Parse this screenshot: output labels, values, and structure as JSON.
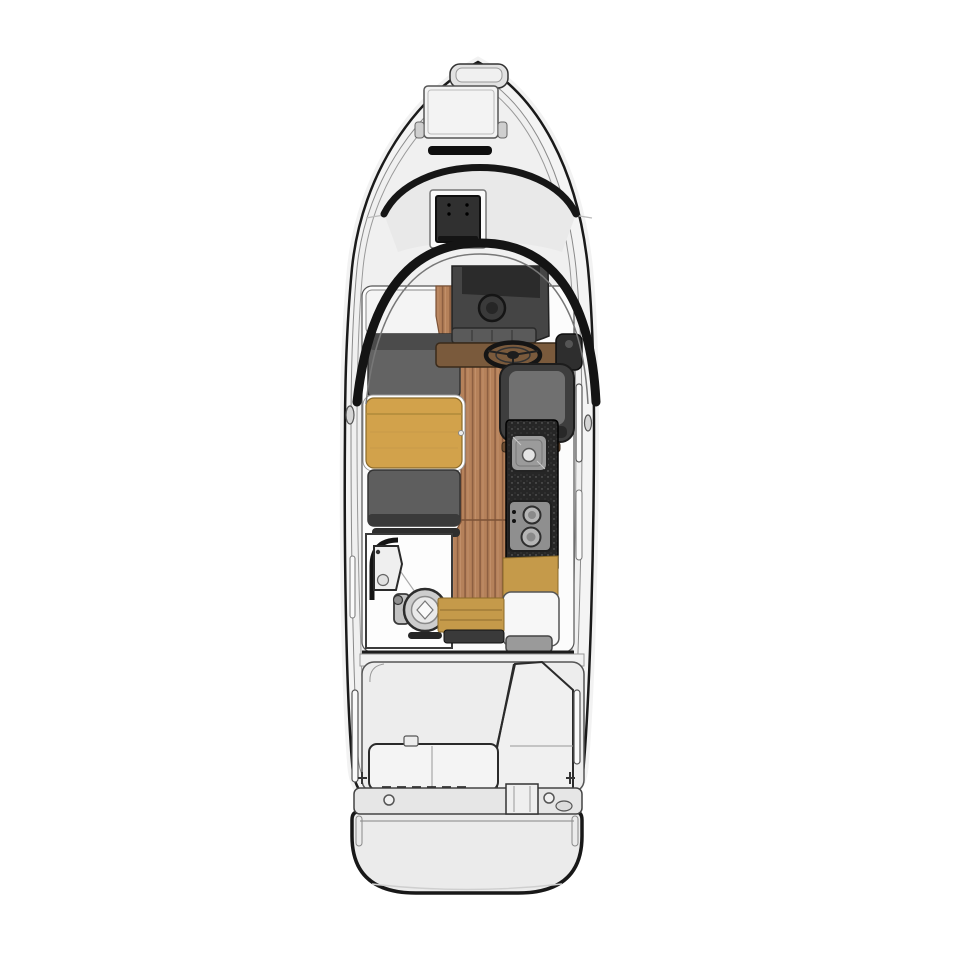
{
  "scene": {
    "type": "boat-deck-plan",
    "view": "top-down-floorplan",
    "subject": "motor-boat-interior-layout"
  },
  "colors": {
    "background": "#ffffff",
    "line": "#1a1a1a",
    "hull": "#f4f4f4",
    "hull_inner": "#f0f0f0",
    "deck": "#e2e2e2",
    "roof": "#e9e9e9",
    "skylight": "#303030",
    "windshield": "#141414",
    "cabin_white": "#fcfcfc",
    "wood_floor": "#b5815a",
    "wood_stripe": "#8d5f41",
    "wood_seam": "#7c5236",
    "table_gold": "#d2a24b",
    "step_gold": "#c59a4a",
    "seat_gray": "#636363",
    "seat_back": "#4b4b4b",
    "seat_aft": "#5e5e5e",
    "helm_seat_dark": "#3e3e3e",
    "helm_seat_inner": "#707070",
    "dash": "#454545",
    "dash_panel": "#2b2b2b",
    "instrument": "#5a5a5a",
    "console_wood": "#7a5a3c",
    "counter_black": "#262626",
    "steel": "#9b9b9b",
    "stove": "#8f8f8f",
    "cockpit": "#ededed",
    "bench_white": "#f4f4f4",
    "transom": "#e6e6e6",
    "platform": "#ebebeb"
  }
}
